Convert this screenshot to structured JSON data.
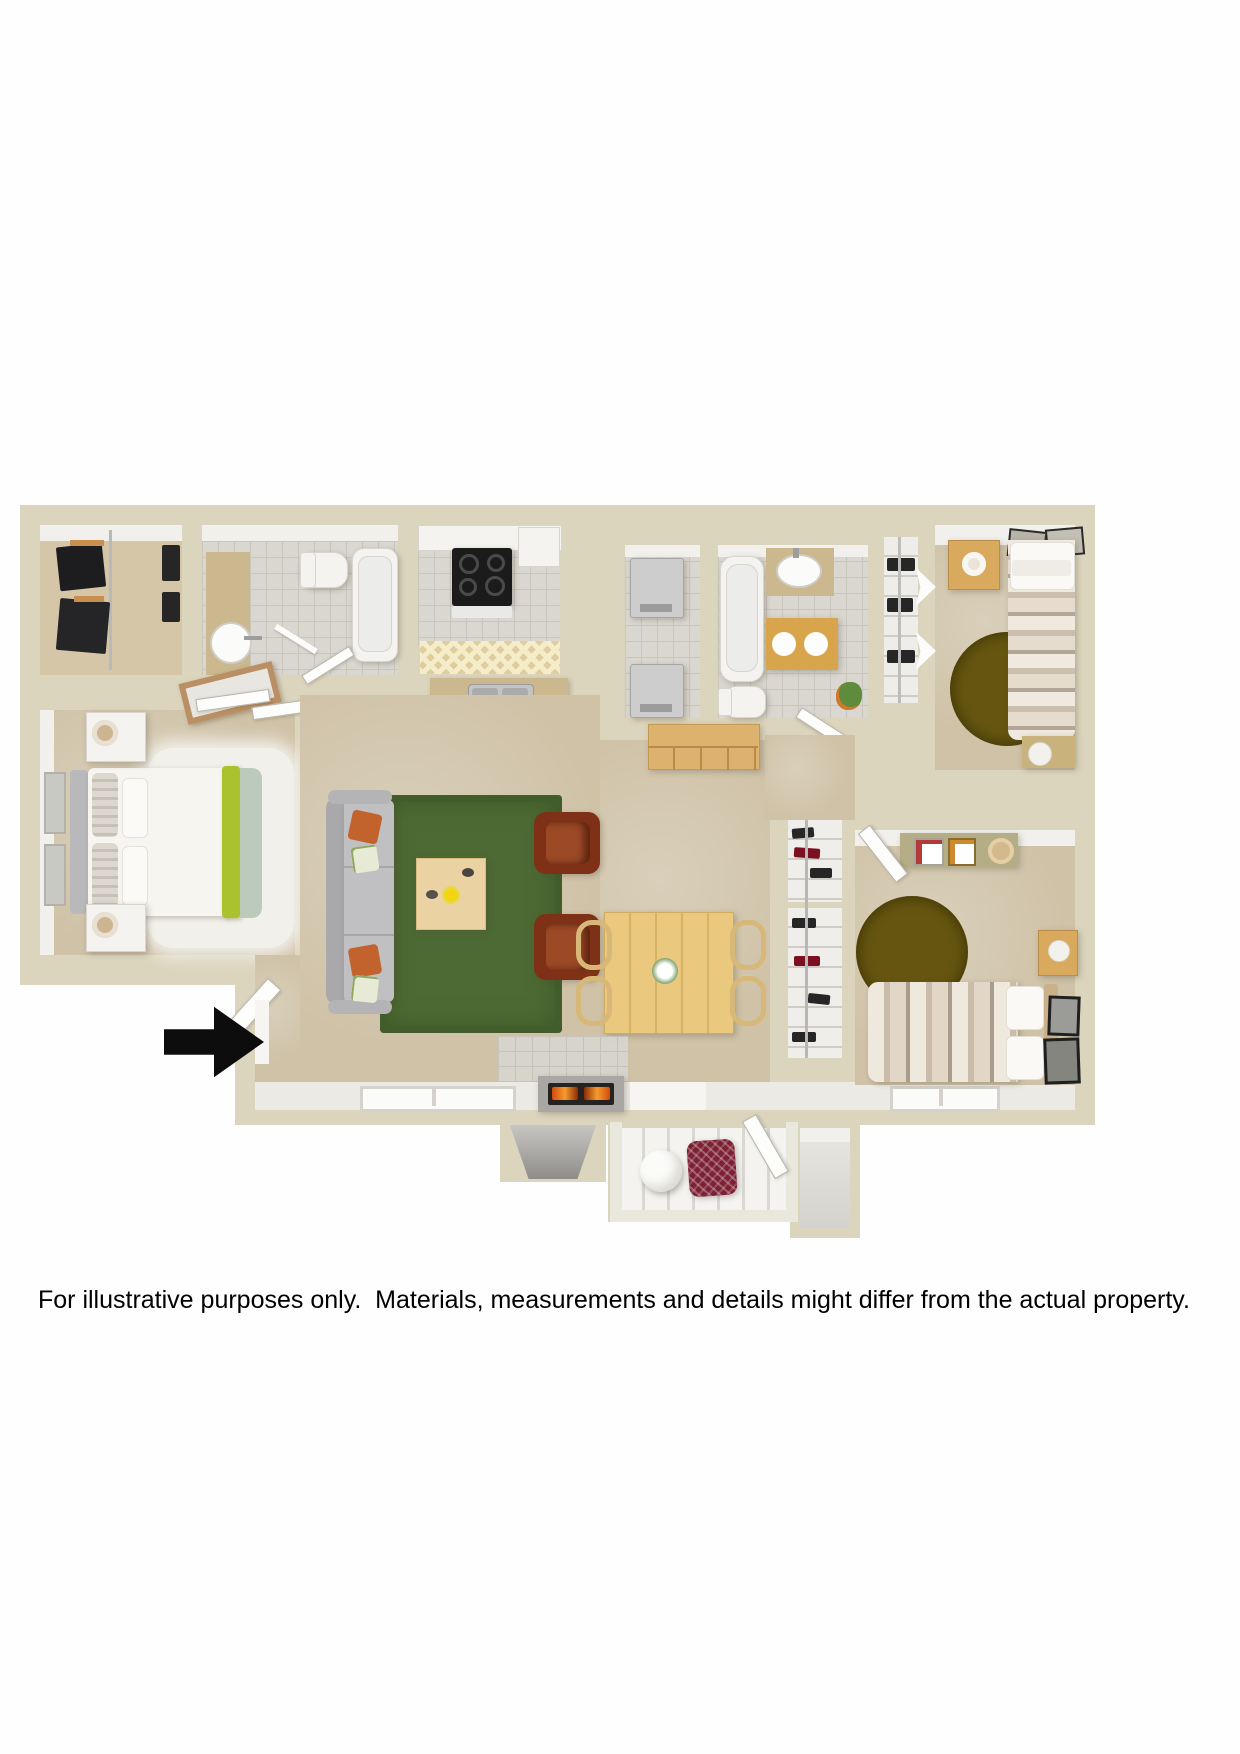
{
  "document": {
    "type": "3d-top-down-floor-plan",
    "disclaimer": "For illustrative purposes only.  Materials, measurements and details might differ from the actual property."
  },
  "floor_plan": {
    "rooms": [
      "walk-in-closet",
      "bathroom-1",
      "kitchen",
      "laundry-closet",
      "bathroom-2",
      "linen-closet",
      "bedroom-1",
      "master-bedroom",
      "living-room",
      "dining-area",
      "hallway",
      "shoe-closets",
      "bedroom-2",
      "patio",
      "storage-closet"
    ],
    "indicators": {
      "entry": {
        "symbol": "arrow-right",
        "color": "#0d0d0d"
      }
    },
    "furniture": {
      "master_bedroom": [
        "queen-bed",
        "two-nightstands",
        "lamps",
        "shag-rug",
        "wall-art",
        "leaning-mirror"
      ],
      "living_room": [
        "sofa",
        "orange-pillows",
        "green-area-rug",
        "coffee-table",
        "two-leather-armchairs",
        "fireplace",
        "console-shelf"
      ],
      "dining_area": [
        "wood-table",
        "four-chairs",
        "flower-vase"
      ],
      "kitchen": [
        "range",
        "refrigerator",
        "double-sink",
        "breakfast-bar",
        "counter"
      ],
      "bathroom_1": [
        "toilet",
        "vessel-sink",
        "bathtub"
      ],
      "bathroom_2": [
        "bathtub",
        "vanity-sink",
        "toilet",
        "bath-mat",
        "plant"
      ],
      "laundry_closet": [
        "washer",
        "dryer"
      ],
      "bedroom_1": [
        "bed",
        "nightstand",
        "lamp",
        "round-rug",
        "desk",
        "stool",
        "wall-art"
      ],
      "bedroom_2": [
        "bed",
        "nightstand",
        "round-rug",
        "desk-shelf",
        "wall-art"
      ],
      "patio": [
        "bistro-table",
        "wicker-chair"
      ]
    }
  },
  "palette": {
    "bg_white": "#fefefe",
    "wall": "#dcd5bd",
    "carpet": "#cfc2a7",
    "tile": "#dad7d0",
    "wood": "#d9a95e",
    "wood_light": "#eac87e",
    "counter_tan": "#cbb88f",
    "gold_mat": "#d9a54c",
    "green_rug": "#4d6a34",
    "olive_rug": "#574909",
    "sofa_gray": "#c0c0c2",
    "armchair_brown": "#7e3116",
    "orange_pillow": "#c2632e",
    "lime_accent": "#a9c22d",
    "sage_accent": "#bccabb",
    "red_chair": "#7c2134",
    "appliance_gray": "#cdcdcd",
    "arrow_black": "#0d0d0d",
    "text_black": "#000000"
  }
}
